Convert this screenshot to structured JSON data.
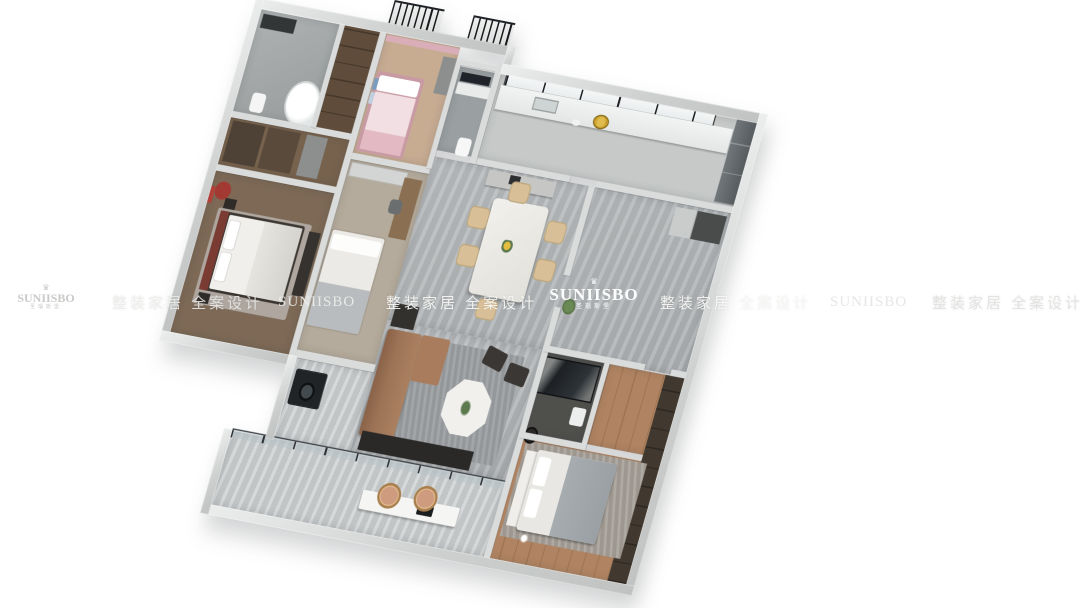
{
  "watermark": {
    "brand": "SUNIISBO",
    "brand_cn": "圣瑙斯堡",
    "tagline": "整装家居 全案设计",
    "crown_glyph": "♛"
  },
  "palette": {
    "background": "#ffffff",
    "wall_exterior": "#cdd0cf",
    "wall_interior": "#dadcdb",
    "floor_marble": "#aeb2b4",
    "floor_balcony": "#c5c9ca",
    "floor_wood": "#b08462",
    "sofa_leather": "#9d7456",
    "dining_chair": "#d8bf98",
    "bed_linen": "#f0efec",
    "accent_red": "#a23a33",
    "accent_pink": "#e3bac3",
    "accent_gold": "#c59a26",
    "dark_fixture": "#2b2927",
    "railing_black": "#17191c"
  }
}
